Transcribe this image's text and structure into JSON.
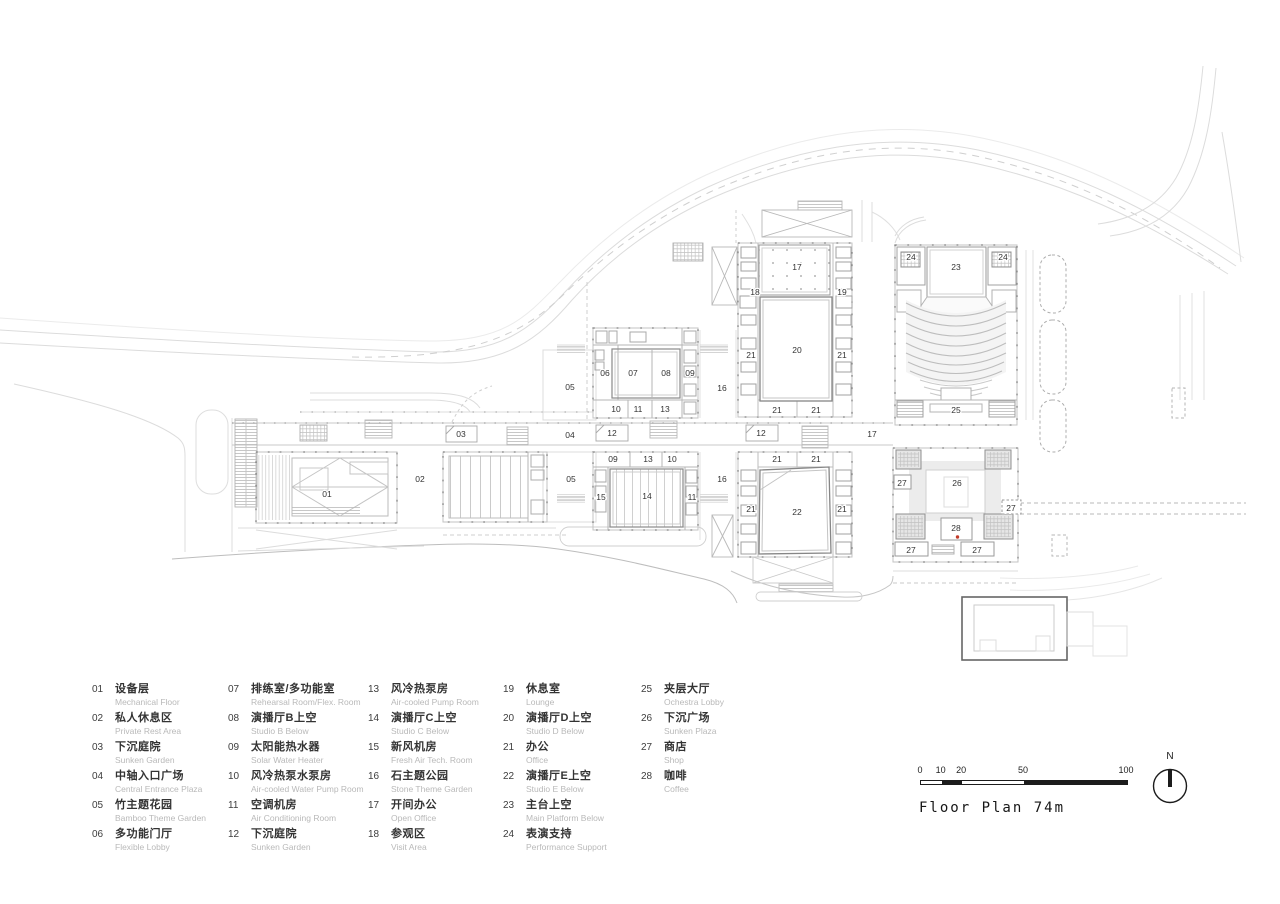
{
  "footer": {
    "title": "Floor Plan 74m"
  },
  "north": {
    "label": "N"
  },
  "scale_bar": {
    "unit_values": [
      0,
      10,
      20,
      50,
      100
    ],
    "px_per_unit": 2.06
  },
  "plan": {
    "red_dot_color": "#c23b2a",
    "labels": [
      {
        "text": "17",
        "x": 797,
        "y": 267
      },
      {
        "text": "18",
        "x": 755,
        "y": 292
      },
      {
        "text": "19",
        "x": 842,
        "y": 292
      },
      {
        "text": "24",
        "x": 911,
        "y": 257
      },
      {
        "text": "23",
        "x": 956,
        "y": 267
      },
      {
        "text": "24",
        "x": 1003,
        "y": 257
      },
      {
        "text": "20",
        "x": 797,
        "y": 350
      },
      {
        "text": "21",
        "x": 751,
        "y": 355
      },
      {
        "text": "21",
        "x": 842,
        "y": 355
      },
      {
        "text": "21",
        "x": 777,
        "y": 410
      },
      {
        "text": "21",
        "x": 816,
        "y": 410
      },
      {
        "text": "25",
        "x": 956,
        "y": 410
      },
      {
        "text": "06",
        "x": 605,
        "y": 373
      },
      {
        "text": "07",
        "x": 633,
        "y": 373
      },
      {
        "text": "08",
        "x": 666,
        "y": 373
      },
      {
        "text": "09",
        "x": 690,
        "y": 373
      },
      {
        "text": "05",
        "x": 570,
        "y": 387
      },
      {
        "text": "16",
        "x": 722,
        "y": 388
      },
      {
        "text": "10",
        "x": 616,
        "y": 409
      },
      {
        "text": "11",
        "x": 638,
        "y": 409
      },
      {
        "text": "13",
        "x": 665,
        "y": 409
      },
      {
        "text": "03",
        "x": 461,
        "y": 434
      },
      {
        "text": "04",
        "x": 570,
        "y": 435
      },
      {
        "text": "12",
        "x": 612,
        "y": 433
      },
      {
        "text": "12",
        "x": 761,
        "y": 433
      },
      {
        "text": "17",
        "x": 872,
        "y": 434
      },
      {
        "text": "01",
        "x": 327,
        "y": 494
      },
      {
        "text": "02",
        "x": 420,
        "y": 479
      },
      {
        "text": "09",
        "x": 613,
        "y": 459
      },
      {
        "text": "13",
        "x": 648,
        "y": 459
      },
      {
        "text": "10",
        "x": 672,
        "y": 459
      },
      {
        "text": "05",
        "x": 571,
        "y": 479
      },
      {
        "text": "16",
        "x": 722,
        "y": 479
      },
      {
        "text": "15",
        "x": 601,
        "y": 497
      },
      {
        "text": "14",
        "x": 647,
        "y": 496
      },
      {
        "text": "11",
        "x": 692,
        "y": 497
      },
      {
        "text": "21",
        "x": 777,
        "y": 459
      },
      {
        "text": "21",
        "x": 816,
        "y": 459
      },
      {
        "text": "21",
        "x": 751,
        "y": 509
      },
      {
        "text": "22",
        "x": 797,
        "y": 512
      },
      {
        "text": "21",
        "x": 842,
        "y": 509
      },
      {
        "text": "27",
        "x": 902,
        "y": 483
      },
      {
        "text": "26",
        "x": 957,
        "y": 483
      },
      {
        "text": "27",
        "x": 1011,
        "y": 508
      },
      {
        "text": "28",
        "x": 956,
        "y": 528
      },
      {
        "text": "27",
        "x": 911,
        "y": 550
      },
      {
        "text": "27",
        "x": 977,
        "y": 550
      }
    ]
  },
  "legend": {
    "columns": [
      {
        "items": [
          {
            "num": "01",
            "zh": "设备层",
            "en": "Mechanical Floor"
          },
          {
            "num": "02",
            "zh": "私人休息区",
            "en": "Private Rest Area"
          },
          {
            "num": "03",
            "zh": "下沉庭院",
            "en": "Sunken Garden"
          },
          {
            "num": "04",
            "zh": "中轴入口广场",
            "en": "Central Entrance Plaza"
          },
          {
            "num": "05",
            "zh": "竹主题花园",
            "en": "Bamboo Theme Garden"
          },
          {
            "num": "06",
            "zh": "多功能门厅",
            "en": "Flexible Lobby"
          }
        ]
      },
      {
        "items": [
          {
            "num": "07",
            "zh": "排练室/多功能室",
            "en": "Rehearsal Room/Flex. Room"
          },
          {
            "num": "08",
            "zh": "演播厅B上空",
            "en": "Studio B Below"
          },
          {
            "num": "09",
            "zh": "太阳能热水器",
            "en": "Solar Water Heater"
          },
          {
            "num": "10",
            "zh": "风冷热泵水泵房",
            "en": "Air-cooled Water Pump Room"
          },
          {
            "num": "11",
            "zh": "空调机房",
            "en": "Air Conditioning Room"
          },
          {
            "num": "12",
            "zh": "下沉庭院",
            "en": "Sunken Garden"
          }
        ]
      },
      {
        "items": [
          {
            "num": "13",
            "zh": "风冷热泵房",
            "en": "Air-cooled Pump Room"
          },
          {
            "num": "14",
            "zh": "演播厅C上空",
            "en": "Studio C Below"
          },
          {
            "num": "15",
            "zh": "新风机房",
            "en": "Fresh Air Tech. Room"
          },
          {
            "num": "16",
            "zh": "石主题公园",
            "en": "Stone Theme Garden"
          },
          {
            "num": "17",
            "zh": "开间办公",
            "en": "Open Office"
          },
          {
            "num": "18",
            "zh": "参观区",
            "en": "Visit Area"
          }
        ]
      },
      {
        "items": [
          {
            "num": "19",
            "zh": "休息室",
            "en": "Lounge"
          },
          {
            "num": "20",
            "zh": "演播厅D上空",
            "en": "Studio D Below"
          },
          {
            "num": "21",
            "zh": "办公",
            "en": "Office"
          },
          {
            "num": "22",
            "zh": "演播厅E上空",
            "en": "Studio E Below"
          },
          {
            "num": "23",
            "zh": "主台上空",
            "en": "Main Platform Below"
          },
          {
            "num": "24",
            "zh": "表演支持",
            "en": "Performance Support"
          }
        ]
      },
      {
        "items": [
          {
            "num": "25",
            "zh": "夹层大厅",
            "en": "Ochestra Lobby"
          },
          {
            "num": "26",
            "zh": "下沉广场",
            "en": "Sunken Plaza"
          },
          {
            "num": "27",
            "zh": "商店",
            "en": "Shop"
          },
          {
            "num": "28",
            "zh": "咖啡",
            "en": "Coffee"
          }
        ]
      }
    ]
  }
}
